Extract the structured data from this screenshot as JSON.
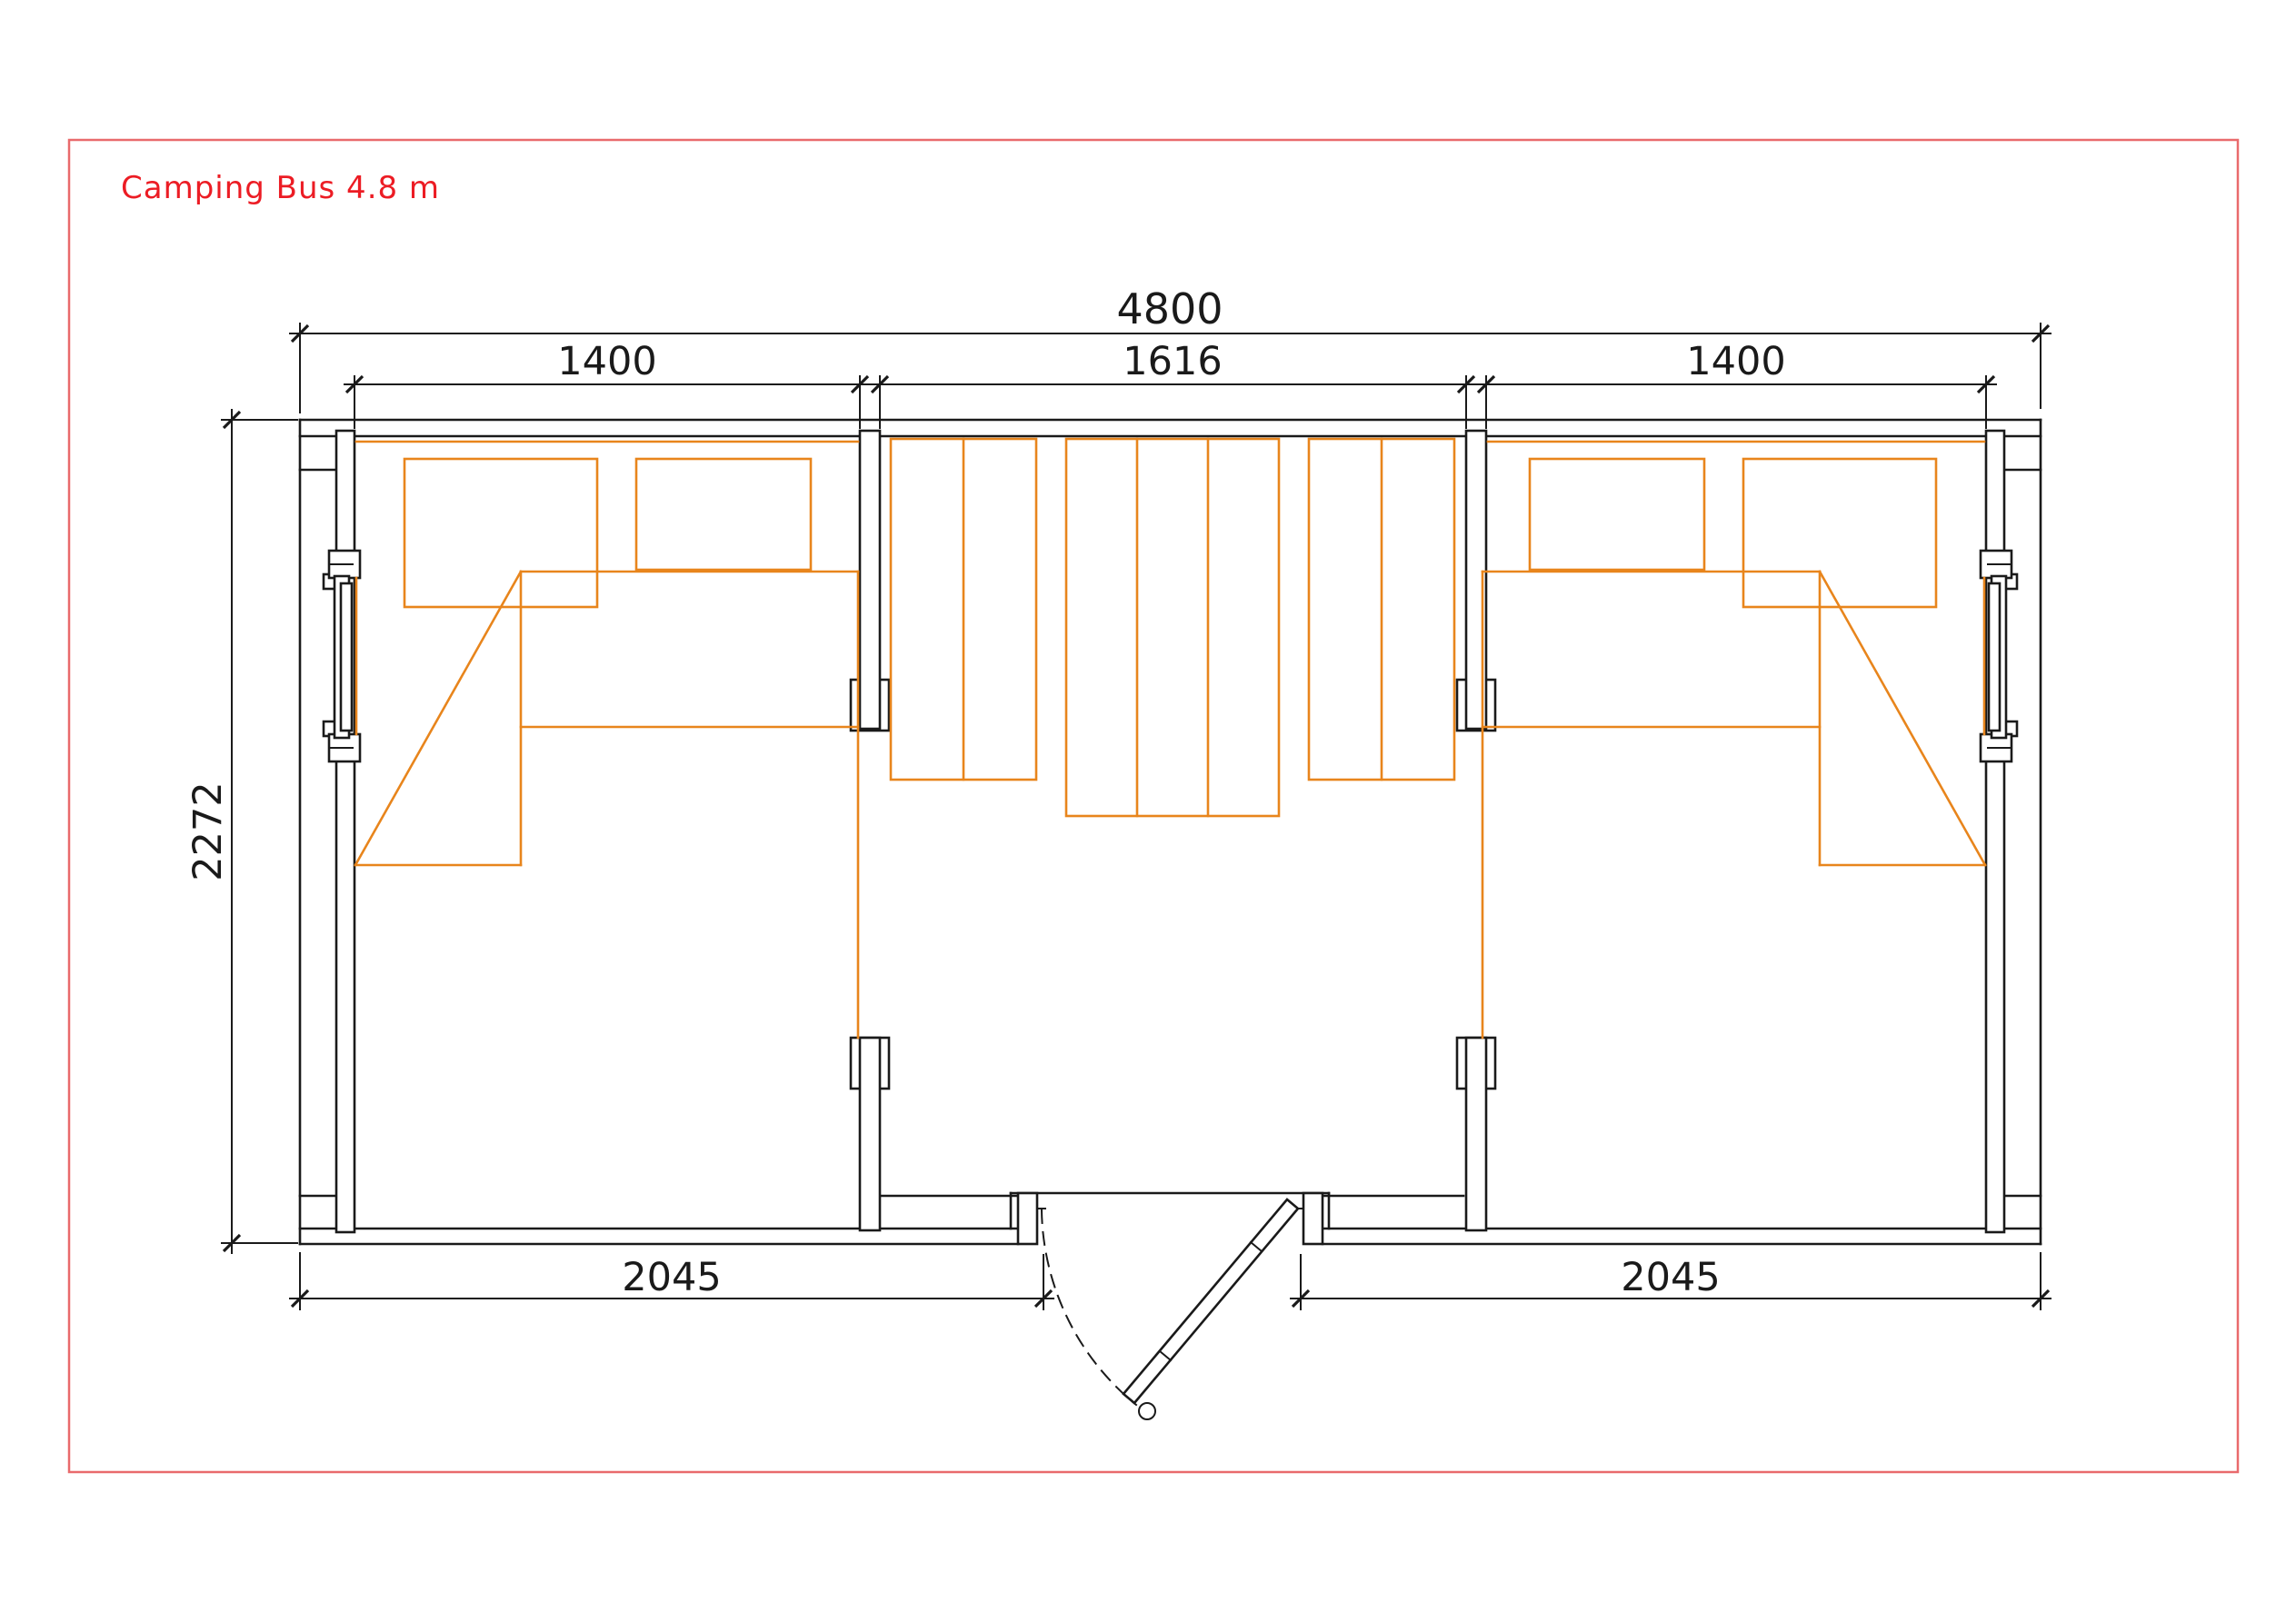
{
  "page": {
    "title": "Camping Bus 4.8 m"
  },
  "colors": {
    "title_red": "#ec1c24",
    "frame_red": "#e96a6c",
    "line_black": "#1a1a1a",
    "furniture_orange": "#e8851c"
  },
  "dimensions": {
    "overall_width": "4800",
    "left_section": "1400",
    "center_section": "1616",
    "right_section": "1400",
    "depth": "2272",
    "bottom_left": "2045",
    "bottom_right": "2045"
  }
}
